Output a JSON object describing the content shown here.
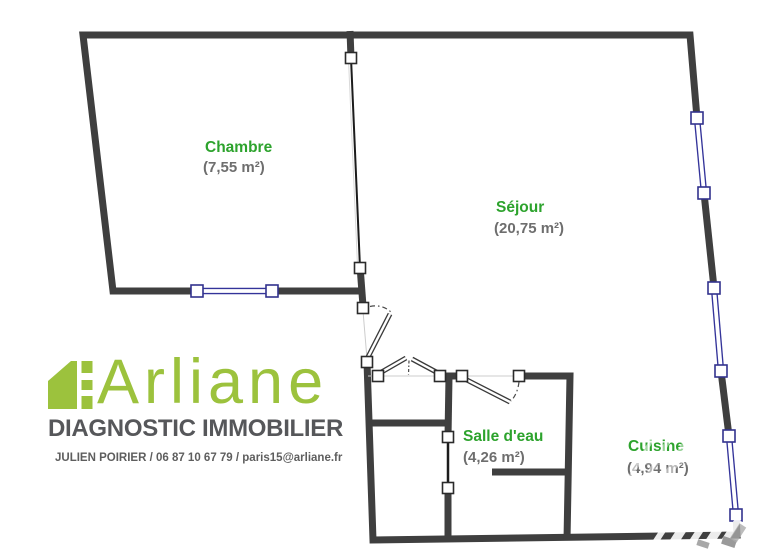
{
  "plan": {
    "rooms": [
      {
        "name": "Chambre",
        "area": "(7,55 m²)"
      },
      {
        "name": "Séjour",
        "area": "(20,75 m²)"
      },
      {
        "name": "Salle d'eau",
        "area": "(4,26 m²)"
      },
      {
        "name": "Cuisine",
        "area": "(4,94 m²)"
      }
    ],
    "colors": {
      "room_label_green": "#2da32d",
      "area_text_grey": "#6e6e6e",
      "wall_dark": "#3f3f3f",
      "window_blue": "#34349a"
    }
  },
  "logo": {
    "brand": "Arliane",
    "tagline": "DIAGNOSTIC IMMOBILIER",
    "contact": "JULIEN POIRIER / 06 87 10 67 79 / paris15@arliane.fr",
    "brand_green": "#9cc23d",
    "text_grey": "#56575a"
  }
}
